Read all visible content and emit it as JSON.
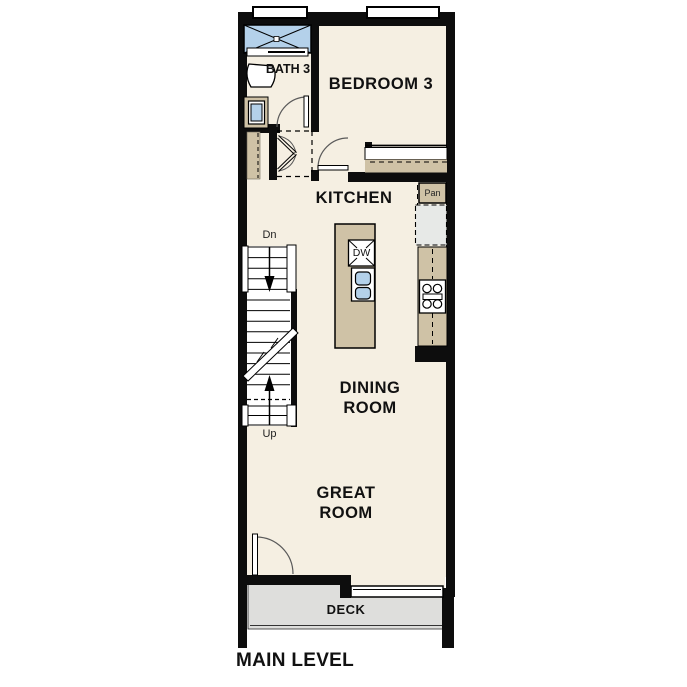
{
  "title": "MAIN LEVEL",
  "colors": {
    "floor": "#f5efe2",
    "wall": "#0d0d0d",
    "tan": "#cfc2a6",
    "blue": "#b4d1ea",
    "deck": "#dededc",
    "fridge": "#e7e9e7",
    "arc": "#5a5a5a"
  },
  "rooms": {
    "bath": "BATH 3",
    "bedroom": "BEDROOM 3",
    "kitchen": "KITCHEN",
    "dining": "DINING ROOM",
    "great": "GREAT ROOM",
    "deck": "DECK"
  },
  "fixtures": {
    "pantry": "Pan",
    "dishwasher": "DW"
  },
  "stairs": {
    "down": "Dn",
    "up": "Up"
  }
}
